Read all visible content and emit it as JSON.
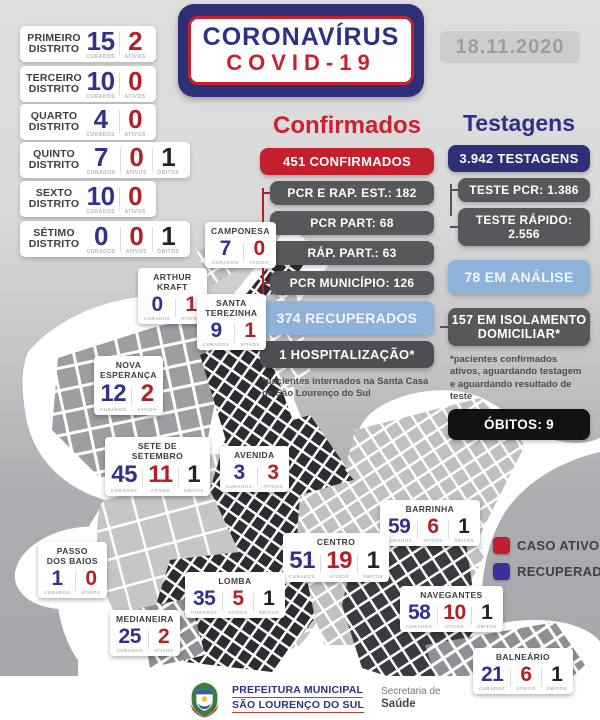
{
  "header": {
    "title_line1": "CORONAVÍRUS",
    "title_line2": "COVID-19",
    "date": "18.11.2020"
  },
  "labels": {
    "curados": "CURADOS",
    "ativos": "ATIVOS",
    "obitos": "ÓBITOS"
  },
  "districts": [
    {
      "name": "PRIMEIRO DISTRITO",
      "curados": "15",
      "ativos": "2"
    },
    {
      "name": "TERCEIRO DISTRITO",
      "curados": "10",
      "ativos": "0"
    },
    {
      "name": "QUARTO DISTRITO",
      "curados": "4",
      "ativos": "0"
    },
    {
      "name": "QUINTO DISTRITO",
      "curados": "7",
      "ativos": "0",
      "obitos": "1"
    },
    {
      "name": "SEXTO DISTRITO",
      "curados": "10",
      "ativos": "0"
    },
    {
      "name": "SÉTIMO DISTRITO",
      "curados": "0",
      "ativos": "0",
      "obitos": "1"
    }
  ],
  "confirmados": {
    "title": "Confirmados",
    "total": "451 CONFIRMADOS",
    "breakdown": [
      "PCR E RAP. EST.: 182",
      "PCR PART: 68",
      "RÁP. PART.: 63",
      "PCR MUNICÍPIO: 126"
    ],
    "recuperados": "374 RECUPERADOS",
    "hospitalizacao": "1 HOSPITALIZAÇÃO*",
    "footnote": "*pacientes internados na Santa Casa de São Lourenço do Sul"
  },
  "testagens": {
    "title": "Testagens",
    "total": "3.942 TESTAGENS",
    "breakdown": [
      "TESTE PCR: 1.386",
      "TESTE RÁPIDO: 2.556"
    ],
    "analise": "78 EM ANÁLISE",
    "isolamento": "157 EM ISOLAMENTO DOMICILIAR*",
    "footnote": "*pacientes confirmados ativos, aguardando testagem e aguardando resultado de teste",
    "obitos": "ÓBITOS: 9"
  },
  "neighborhoods": [
    {
      "name": "CAMPONESA",
      "curados": "7",
      "ativos": "0"
    },
    {
      "name": "ARTHUR\nKRAFT",
      "curados": "0",
      "ativos": "1"
    },
    {
      "name": "SANTA\nTEREZINHA",
      "curados": "9",
      "ativos": "1"
    },
    {
      "name": "NOVA\nESPERANÇA",
      "curados": "12",
      "ativos": "2"
    },
    {
      "name": "SETE DE\nSETEMBRO",
      "curados": "45",
      "ativos": "11",
      "obitos": "1"
    },
    {
      "name": "AVENIDA",
      "curados": "3",
      "ativos": "3"
    },
    {
      "name": "BARRINHA",
      "curados": "59",
      "ativos": "6",
      "obitos": "1"
    },
    {
      "name": "CENTRO",
      "curados": "51",
      "ativos": "19",
      "obitos": "1"
    },
    {
      "name": "PASSO\nDOS BAIOS",
      "curados": "1",
      "ativos": "0"
    },
    {
      "name": "LOMBA",
      "curados": "35",
      "ativos": "5",
      "obitos": "1"
    },
    {
      "name": "MEDIANEIRA",
      "curados": "25",
      "ativos": "2"
    },
    {
      "name": "NAVEGANTES",
      "curados": "58",
      "ativos": "10",
      "obitos": "1"
    },
    {
      "name": "BALNEÁRIO",
      "curados": "21",
      "ativos": "6",
      "obitos": "1"
    }
  ],
  "legend": {
    "caso_ativo": "CASO ATIVO",
    "recuperado": "RECUPERADO"
  },
  "footer": {
    "org_line1": "PREFEITURA MUNICIPAL",
    "org_line2": "SÃO LOURENÇO DO SUL",
    "dept_line1": "Secretaria de",
    "dept_line2": "Saúde"
  },
  "colors": {
    "navy": "#34318e",
    "red": "#b22027",
    "pill_red": "#c41f2e",
    "pill_gray": "#58585c",
    "pill_blue": "#8fb2da",
    "pill_black": "#121214",
    "banner_navy": "#2d3077",
    "legend_active": "#c31e2e",
    "legend_recovered": "#39329a"
  }
}
